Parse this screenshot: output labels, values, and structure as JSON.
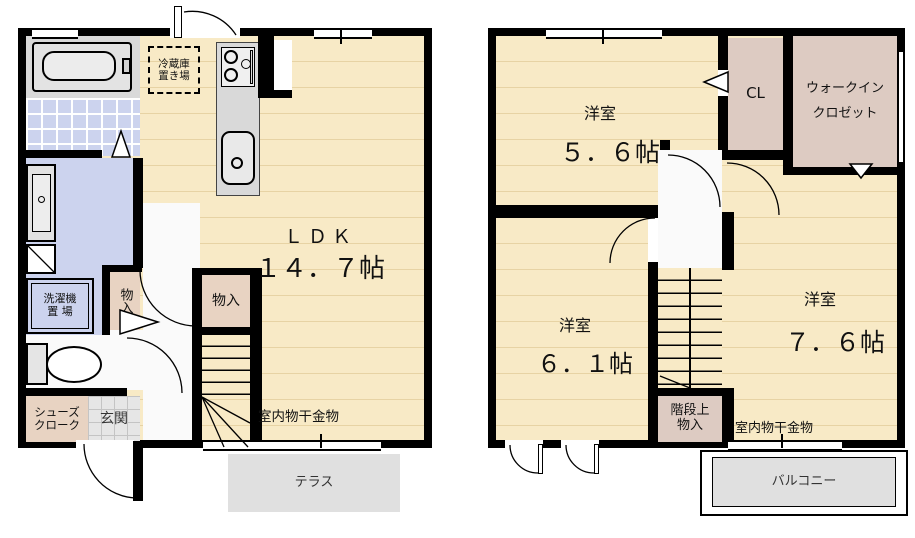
{
  "palette": {
    "wall": "#000000",
    "wood_floor": "#f8eac6",
    "floor_line": "#e7d3a4",
    "bath_tile": "#ccd3ee",
    "closet_1f": "#e8d3c2",
    "closet_2f": "#ddcbc2",
    "entry_tile": "#e6e6e6",
    "outdoor_gray": "#e0e0e0",
    "counter_gray": "#d9d9d9"
  },
  "f1": {
    "fridge_line1": "冷蔵庫",
    "fridge_line2": "置き場",
    "ldk_label": "ＬＤＫ",
    "ldk_size": "１４．７帖",
    "storage_hall": "物入",
    "storage_stair": "物入",
    "laundry_line1": "洗濯機",
    "laundry_line2": "置 場",
    "shoes_line1": "シューズ",
    "shoes_line2": "クローク",
    "entrance": "玄関",
    "drying": "室内物干金物",
    "terrace": "テラス"
  },
  "f2": {
    "room_a_label": "洋室",
    "room_a_size": "５．６帖",
    "cl": "CL",
    "wic_line1": "ウォークイン",
    "wic_line2": "クロゼット",
    "room_b_label": "洋室",
    "room_b_size": "６．１帖",
    "room_c_label": "洋室",
    "room_c_size": "７．６帖",
    "stair_storage_line1": "階段上",
    "stair_storage_line2": "物入",
    "drying": "室内物干金物",
    "balcony": "バルコニー"
  }
}
